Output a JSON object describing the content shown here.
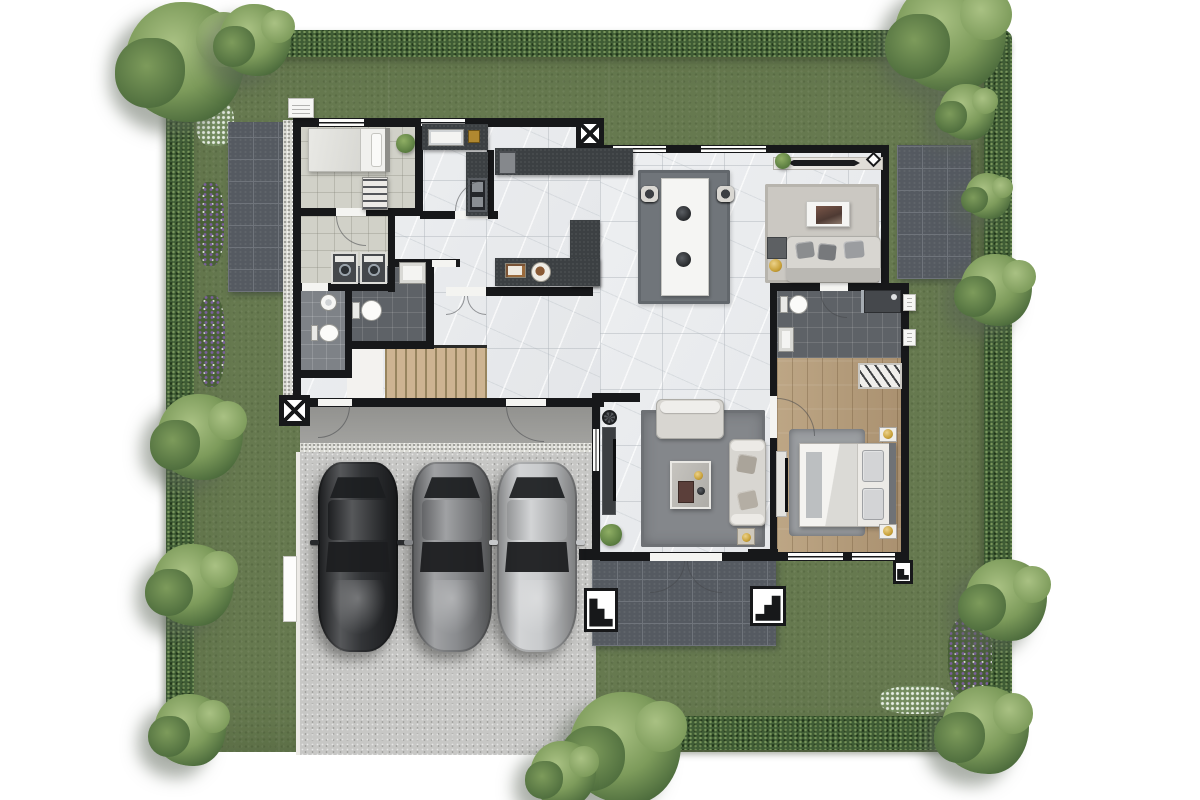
{
  "meta": {
    "description": "Top-down 3D rendered residential floor plan with surrounding garden, three-car driveway and furnished rooms",
    "visible_text": "none"
  },
  "palette": {
    "grass": "#66794f",
    "hedge": "#3f5c35",
    "tree_light": "#a9c183",
    "tree_mid": "#7d9b5b",
    "tree_dark": "#4c6b3c",
    "wall": "#17181a",
    "marble": "#e9ebed",
    "tile_service": "#d1d1c8",
    "tile_bath_light": "#7e8287",
    "tile_bath_dark": "#5e6267",
    "wood": "#b49c79",
    "wood_stairs": "#cdb492",
    "patio": "#555a61",
    "patio_line": "#6f747b",
    "concrete": "#c7c7c5",
    "porch": "#a2a29f",
    "gravel": "#d9d9d3",
    "rug_dining": "#70757a",
    "rug_living": "#84878b",
    "rug_sitting": "#cbc8c2",
    "rug_bedroom": "#9b9ea1",
    "sofa": "#d8d6d1",
    "cushion": "#8b8d8f",
    "counter": "#3c4043",
    "gold": "#c9a23a",
    "flower_purple": "#7b5f9e",
    "flower_white": "#e8efe6",
    "car_dark": "#27292c",
    "car_gray": "#85878a",
    "car_silver": "#c6c8ca",
    "glass": "#1c1e20"
  },
  "site": {
    "lawn": "rectangular lot with lawn and clipped hedge border",
    "hedges": [
      "top",
      "left",
      "right",
      "bottom-right"
    ],
    "patios": [
      "west slate patio",
      "northeast slate patio",
      "front terrace with steps"
    ],
    "trees": [
      {
        "x": 185,
        "y": 62,
        "d": 120
      },
      {
        "x": 255,
        "y": 40,
        "d": 72
      },
      {
        "x": 950,
        "y": 36,
        "d": 112
      },
      {
        "x": 967,
        "y": 112,
        "d": 56
      },
      {
        "x": 988,
        "y": 196,
        "d": 46
      },
      {
        "x": 996,
        "y": 290,
        "d": 72
      },
      {
        "x": 1006,
        "y": 600,
        "d": 82
      },
      {
        "x": 985,
        "y": 730,
        "d": 88
      },
      {
        "x": 625,
        "y": 748,
        "d": 112
      },
      {
        "x": 563,
        "y": 774,
        "d": 66
      },
      {
        "x": 200,
        "y": 437,
        "d": 86
      },
      {
        "x": 193,
        "y": 585,
        "d": 82
      },
      {
        "x": 190,
        "y": 730,
        "d": 72
      }
    ],
    "flower_patches": [
      "white (upper-left)",
      "purple (left x2)",
      "purple (lower-right)",
      "white (lower-right)"
    ]
  },
  "house": {
    "rooms": [
      "maid bedroom",
      "laundry room",
      "bathroom 1",
      "bathroom 2",
      "thai kitchen",
      "main kitchen",
      "dining area",
      "sitting area",
      "living area",
      "master bedroom",
      "master bathroom",
      "staircase",
      "hallway",
      "rear porch",
      "front terrace"
    ],
    "dining": {
      "chairs_per_side": 4,
      "table": "8-seat rectangular table with 2 centerpieces"
    },
    "kitchen": {
      "items": [
        "double sink",
        "fridge",
        "cooktop island L-counter",
        "serving plates"
      ]
    },
    "sitting": {
      "items": [
        "console with decor",
        "area rug",
        "low art table",
        "3-seat sofa",
        "gold lamp"
      ]
    },
    "living": {
      "items": [
        "sofa",
        "chaise sofa",
        "coffee table",
        "side table",
        "TV console",
        "pedestal fan",
        "plant"
      ]
    },
    "master_bedroom": {
      "items": [
        "double bed",
        "2 nightstands with gold lamps",
        "wardrobe with hangers",
        "TV cabinet",
        "area rug"
      ]
    },
    "master_bathroom": {
      "items": [
        "toilet",
        "vanity sink",
        "walk-in shower"
      ]
    },
    "maid_room": {
      "items": [
        "single bed",
        "open shelf"
      ]
    },
    "laundry": {
      "washing_machines": 2
    },
    "stairs": {
      "treads": 10,
      "landing": true
    }
  },
  "garage": {
    "cars": [
      {
        "name": "car-dark-charcoal",
        "color": "#27292c"
      },
      {
        "name": "car-gray",
        "color": "#85878a"
      },
      {
        "name": "car-silver",
        "color": "#c6c8ca"
      }
    ]
  }
}
